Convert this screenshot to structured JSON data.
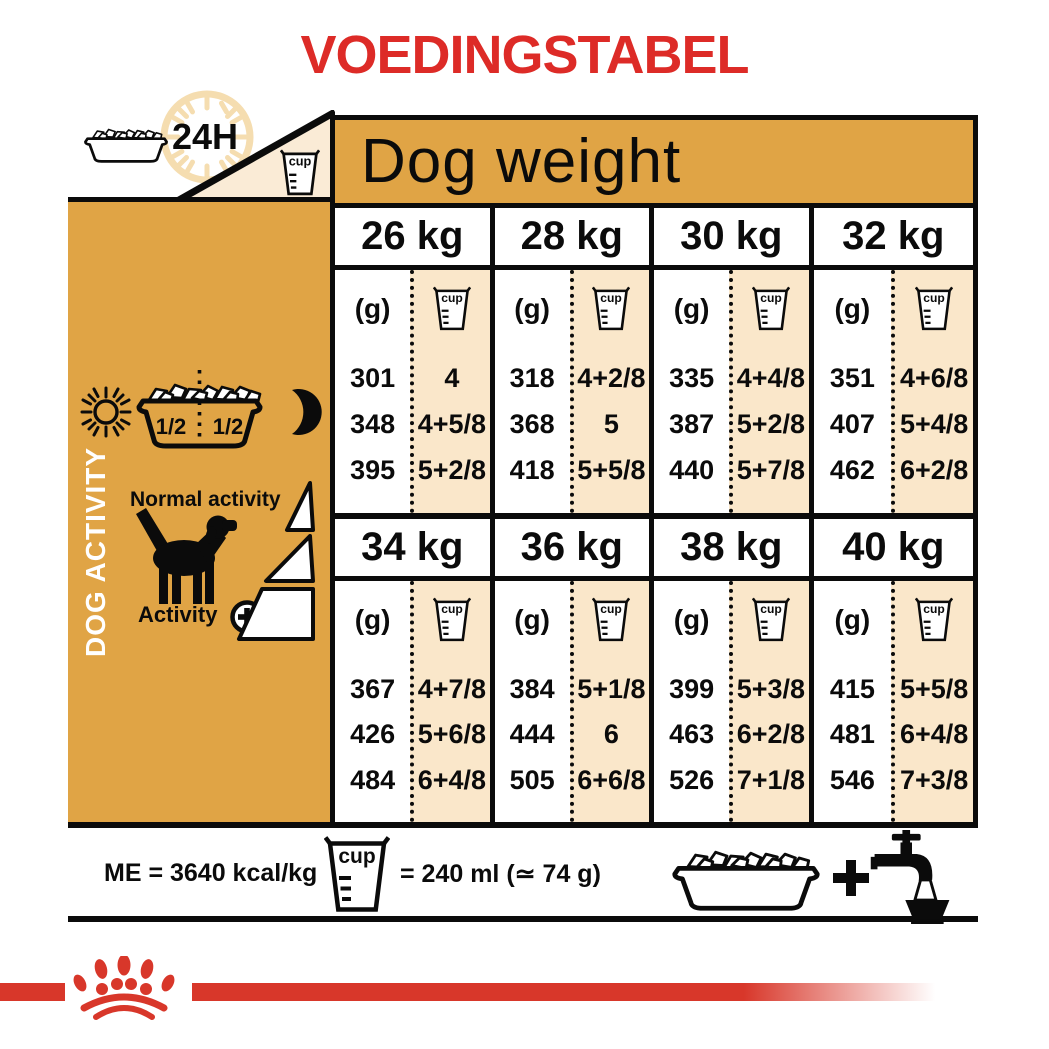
{
  "title": "VOEDINGSTABEL",
  "header": {
    "h24": "24H",
    "dog_weight": "Dog weight"
  },
  "cup_word": "cup",
  "sidebar": {
    "dog_activity": "DOG ACTIVITY",
    "half": "1/2",
    "normal_activity": "Normal activity",
    "activity": "Activity",
    "activity_plus": "+"
  },
  "table": {
    "g_label": "(g)",
    "blocks": [
      {
        "columns": [
          {
            "weight": "26 kg",
            "rows": [
              {
                "g": "301",
                "cup": "4"
              },
              {
                "g": "348",
                "cup": "4+5/8"
              },
              {
                "g": "395",
                "cup": "5+2/8"
              }
            ]
          },
          {
            "weight": "28 kg",
            "rows": [
              {
                "g": "318",
                "cup": "4+2/8"
              },
              {
                "g": "368",
                "cup": "5"
              },
              {
                "g": "418",
                "cup": "5+5/8"
              }
            ]
          },
          {
            "weight": "30 kg",
            "rows": [
              {
                "g": "335",
                "cup": "4+4/8"
              },
              {
                "g": "387",
                "cup": "5+2/8"
              },
              {
                "g": "440",
                "cup": "5+7/8"
              }
            ]
          },
          {
            "weight": "32 kg",
            "rows": [
              {
                "g": "351",
                "cup": "4+6/8"
              },
              {
                "g": "407",
                "cup": "5+4/8"
              },
              {
                "g": "462",
                "cup": "6+2/8"
              }
            ]
          }
        ]
      },
      {
        "columns": [
          {
            "weight": "34 kg",
            "rows": [
              {
                "g": "367",
                "cup": "4+7/8"
              },
              {
                "g": "426",
                "cup": "5+6/8"
              },
              {
                "g": "484",
                "cup": "6+4/8"
              }
            ]
          },
          {
            "weight": "36 kg",
            "rows": [
              {
                "g": "384",
                "cup": "5+1/8"
              },
              {
                "g": "444",
                "cup": "6"
              },
              {
                "g": "505",
                "cup": "6+6/8"
              }
            ]
          },
          {
            "weight": "38 kg",
            "rows": [
              {
                "g": "399",
                "cup": "5+3/8"
              },
              {
                "g": "463",
                "cup": "6+2/8"
              },
              {
                "g": "526",
                "cup": "7+1/8"
              }
            ]
          },
          {
            "weight": "40 kg",
            "rows": [
              {
                "g": "415",
                "cup": "5+5/8"
              },
              {
                "g": "481",
                "cup": "6+4/8"
              },
              {
                "g": "546",
                "cup": "7+3/8"
              }
            ]
          }
        ]
      }
    ]
  },
  "legend": {
    "me_text": "ME = 3640 kcal/kg",
    "cup_equiv": "= 240 ml (≃ 74 g)",
    "plus": "+"
  },
  "icons": {
    "clock": "24h-clock-dial",
    "cup": "measuring-cup",
    "bowl": "kibble-bowl",
    "sun": "sun",
    "moon": "moon",
    "dog": "dog-silhouette",
    "ramps": "activity-ramps",
    "plus_circle": "plus-circle",
    "tap": "water-tap",
    "logo": "royal-canin-crown-paw"
  },
  "colors": {
    "accent_red": "#DD2B27",
    "logo_red": "#D8372A",
    "table_orange": "#E0A445",
    "cream": "#FAE7CA",
    "triangle_cream": "#FAEBD6",
    "clock_tan": "#F5DDB0"
  }
}
